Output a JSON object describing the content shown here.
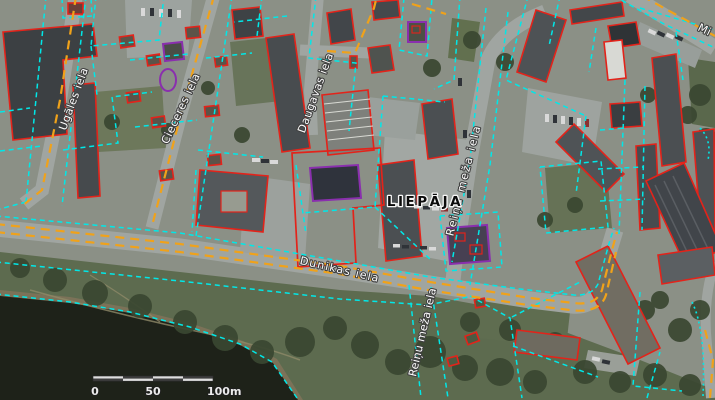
{
  "map": {
    "city_label": "LIEPĀJA",
    "street_labels": {
      "ugales": "Ugāles iela",
      "cieceres": "Cieceres iela",
      "daugavas": "Daugavas iela",
      "dunikas": "Dunikas iela",
      "reinu_meza_upper": "Reiņu meža iela",
      "reinu_meza_lower": "Reiņu meža iela",
      "partial_top_right": "Mi"
    },
    "scale_bar": {
      "tick_0": "0",
      "tick_50": "50",
      "tick_100": "100m"
    },
    "overlay_colors": {
      "parcel_boundary": "#00e8e8",
      "building_outline": "#e3231a",
      "road_centerline": "#f0a21a",
      "protected_building_outline": "#8a2fae"
    }
  }
}
